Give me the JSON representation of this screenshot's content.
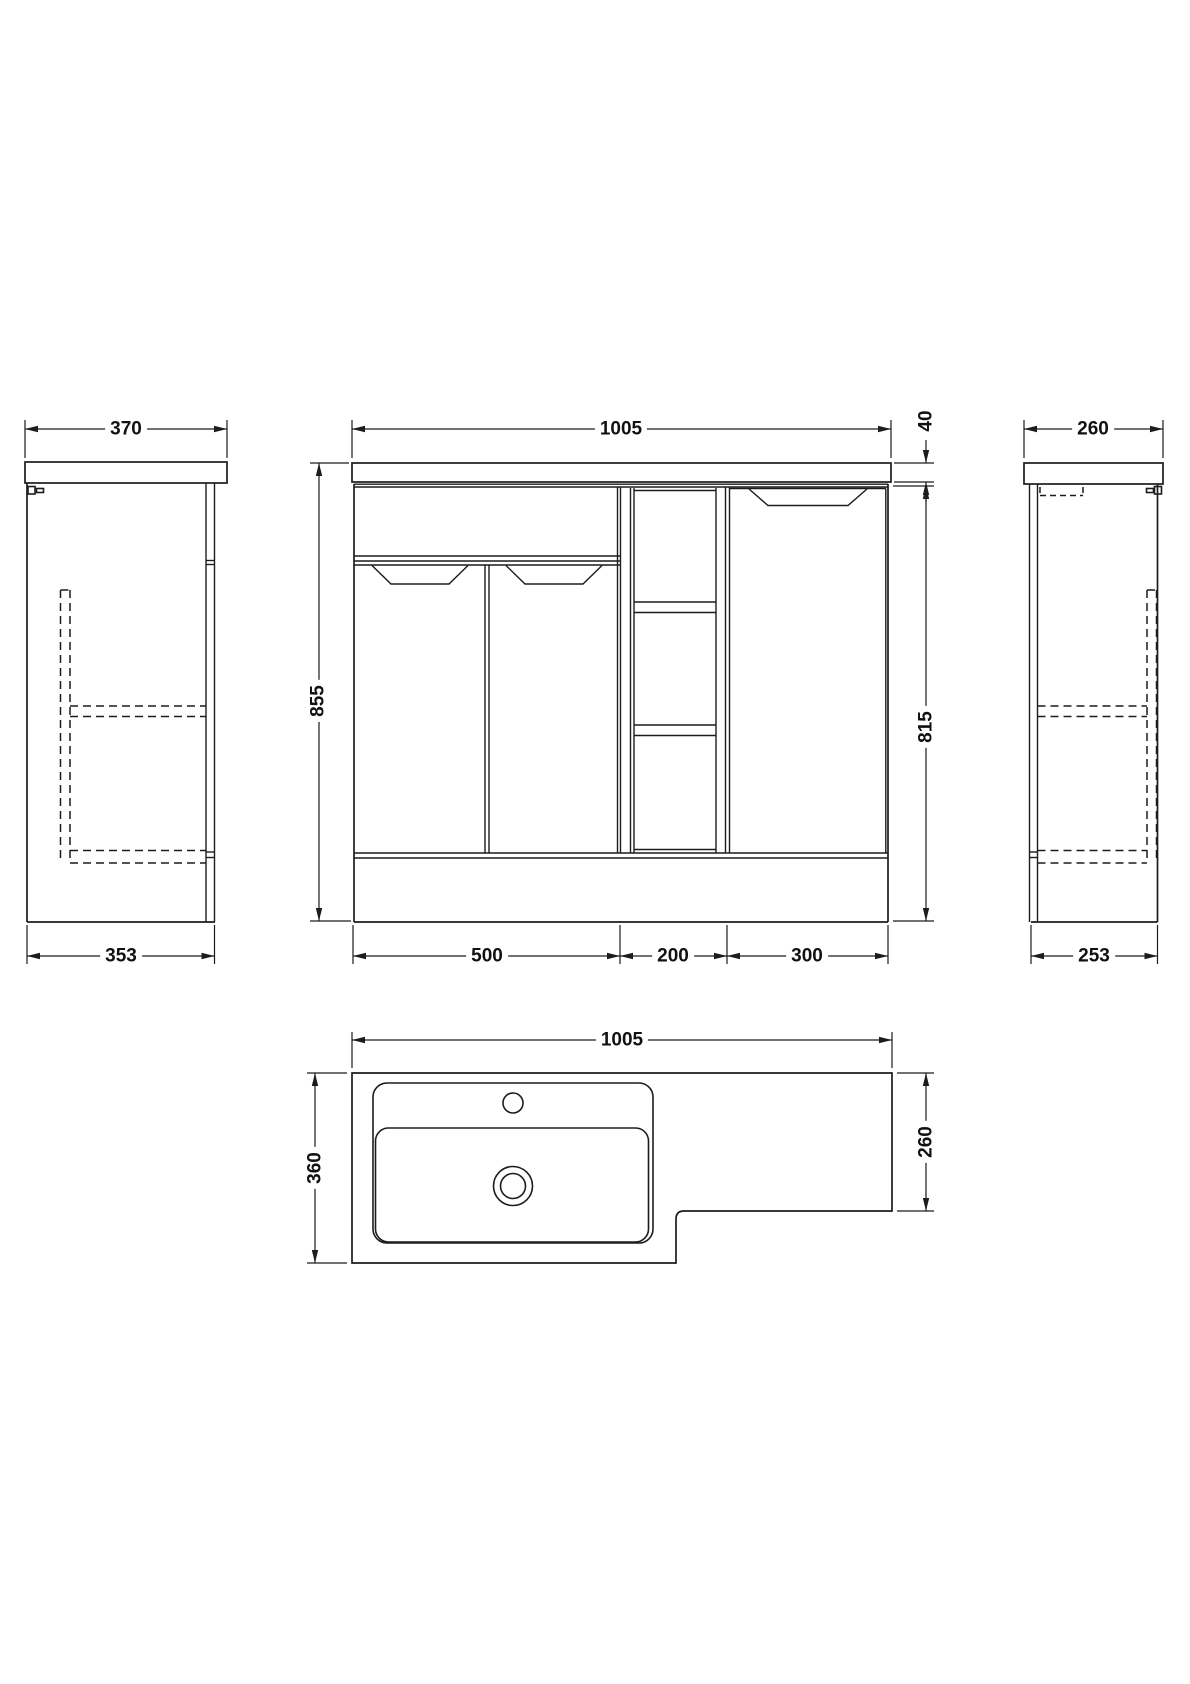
{
  "drawing": {
    "background": "#ffffff",
    "line_color": "#1c1c1c",
    "units": "mm"
  },
  "views": {
    "side_left": {
      "label": "left-end-view",
      "dims": {
        "worktop_depth": "370",
        "cabinet_depth": "353"
      }
    },
    "front": {
      "label": "front-view",
      "dims": {
        "overall_width": "1005",
        "worktop_thickness": "40",
        "overall_height": "855",
        "cabinet_height": "815",
        "sections": [
          "500",
          "200",
          "300"
        ]
      }
    },
    "side_right": {
      "label": "right-end-view",
      "dims": {
        "worktop_depth": "260",
        "cabinet_depth": "253"
      }
    },
    "plan": {
      "label": "plan-view",
      "dims": {
        "overall_width": "1005",
        "depth_left": "360",
        "depth_right": "260"
      }
    }
  }
}
